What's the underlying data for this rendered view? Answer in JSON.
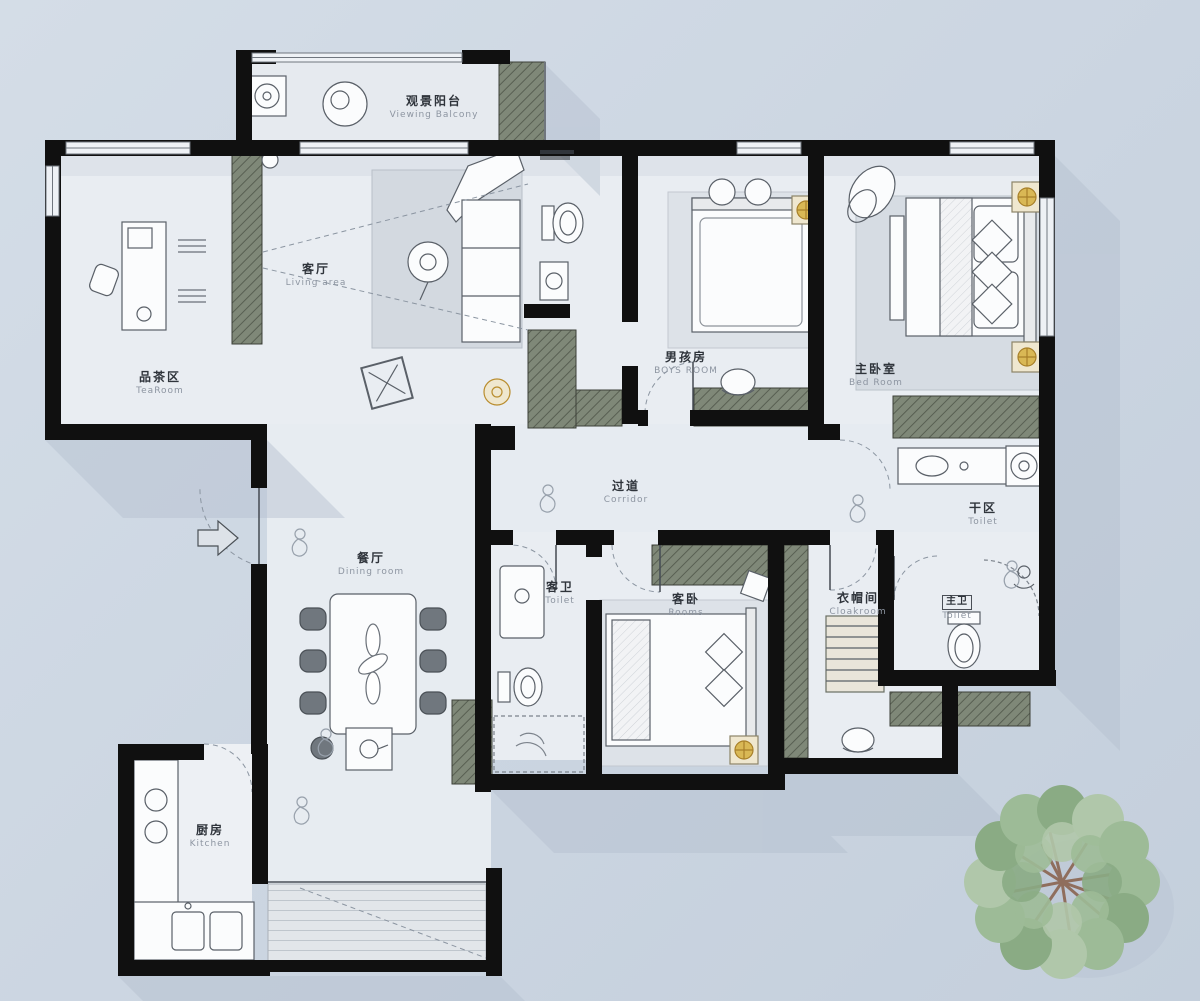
{
  "title": "apartment-floor-plan",
  "rooms": [
    {
      "id": "viewing-balcony",
      "zh": "观景阳台",
      "en": "Viewing Balcony"
    },
    {
      "id": "living-area",
      "zh": "客厅",
      "en": "Living area"
    },
    {
      "id": "tea-room",
      "zh": "品茶区",
      "en": "TeaRoom"
    },
    {
      "id": "boys-room",
      "zh": "男孩房",
      "en": "BOYS ROOM"
    },
    {
      "id": "master-bedroom",
      "zh": "主卧室",
      "en": "Bed Room"
    },
    {
      "id": "corridor",
      "zh": "过道",
      "en": "Corridor"
    },
    {
      "id": "dry-area",
      "zh": "干区",
      "en": "Toilet"
    },
    {
      "id": "dining-room",
      "zh": "餐厅",
      "en": "Dining room"
    },
    {
      "id": "guest-toilet",
      "zh": "客卫",
      "en": "Toilet"
    },
    {
      "id": "guest-bedroom",
      "zh": "客卧",
      "en": "Rooms"
    },
    {
      "id": "cloakroom",
      "zh": "衣帽间",
      "en": "Cloakroom"
    },
    {
      "id": "master-toilet",
      "zh": "主卫",
      "en": "Toilet"
    },
    {
      "id": "kitchen",
      "zh": "厨房",
      "en": "Kitchen"
    }
  ],
  "palette": {
    "background": "#cdd7e2",
    "floor": "#e9edf2",
    "wall": "#101010",
    "shadow": "#b3bfce",
    "cabinet_olive": "#7f8878",
    "gold_light": "#c9a227",
    "tree_green": "#9dbb97",
    "rug": "#d3d9e0"
  }
}
